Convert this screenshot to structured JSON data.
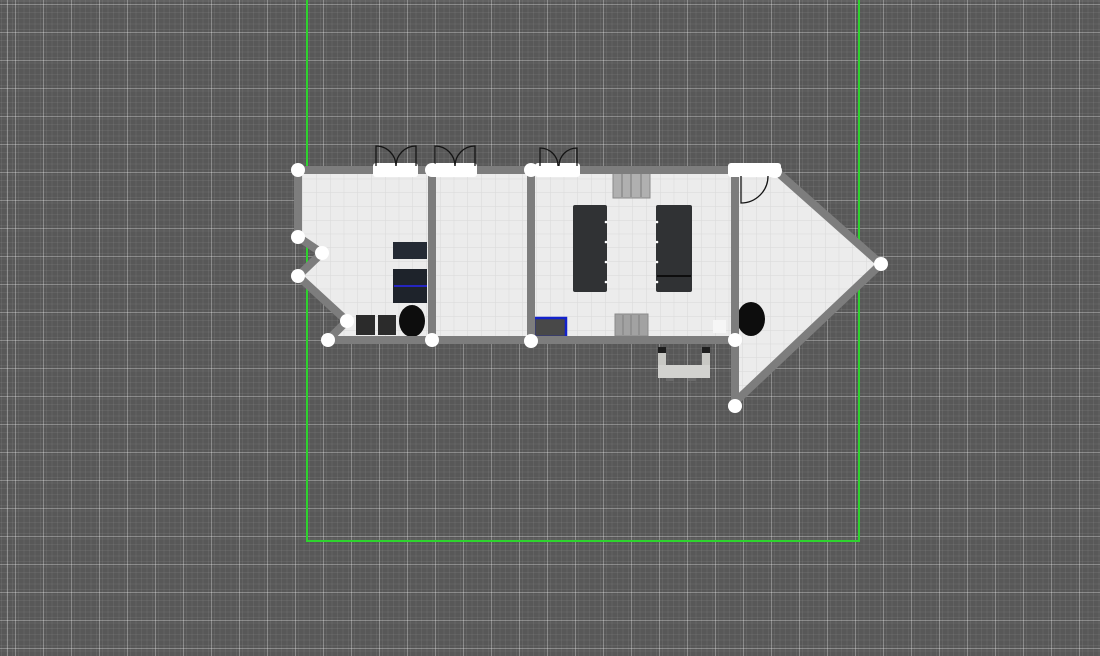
{
  "canvas": {
    "width": 1100,
    "height": 656,
    "background": "#585858"
  },
  "grid": {
    "major_spacing": 28,
    "minor_spacing": 5.6,
    "major_color": "rgba(255,255,255,0.30)",
    "minor_color": "rgba(255,255,255,0.06)"
  },
  "selection_bounds": {
    "name": "plan-boundary-rectangle",
    "color": "#2ed32e",
    "stroke_width": 2,
    "points": "307,0 307,541 859,541 859,0"
  },
  "floor": {
    "name": "building-floor",
    "fill": "#ececec",
    "grid_spacing": 13.75,
    "grid_color": "rgba(100,100,100,0.14)",
    "outline_points": "298,170 775,170 881,264 735,406 735,340 328,340 347,321 298,276 322,253 298,237"
  },
  "walls": {
    "color": "#7d7d7d",
    "thickness": 8,
    "polylines": [
      {
        "name": "wall-top-and-roof-gable",
        "points": "294,170 775,170 881,264 735,402"
      },
      {
        "name": "wall-left-zigzag",
        "points": "298,166 298,237 322,253 298,276 347,321 328,340"
      },
      {
        "name": "wall-bottom",
        "points": "324,340 737,340"
      },
      {
        "name": "wall-interior-1",
        "points": "432,170 432,340"
      },
      {
        "name": "wall-interior-2",
        "points": "531,170 531,340"
      },
      {
        "name": "wall-interior-3",
        "points": "735,166 735,406"
      }
    ]
  },
  "doors": {
    "gap_color": "#ffffff",
    "arc_color": "#141414",
    "wall_face_y": 166,
    "openings": [
      {
        "name": "double-door-1",
        "x": 373,
        "y": 163,
        "w": 45,
        "h": 14,
        "hinge1": 376,
        "hinge2": 416,
        "r": 20
      },
      {
        "name": "double-door-2",
        "x": 430,
        "y": 163,
        "w": 47,
        "h": 14,
        "hinge1": 435,
        "hinge2": 475,
        "r": 20
      },
      {
        "name": "double-door-3",
        "x": 535,
        "y": 163,
        "w": 45,
        "h": 14,
        "hinge1": 540,
        "hinge2": 577,
        "r": 18
      },
      {
        "name": "door-4",
        "x": 728,
        "y": 163,
        "w": 53,
        "h": 14
      }
    ],
    "swing_door": {
      "name": "door-4-swing",
      "hinge_x": 741,
      "hinge_y": 176,
      "radius": 27
    }
  },
  "handles": {
    "color": "#ffffff",
    "radius": 7,
    "points": [
      [
        298,
        170
      ],
      [
        298,
        237
      ],
      [
        322,
        253
      ],
      [
        298,
        276
      ],
      [
        347,
        321
      ],
      [
        328,
        340
      ],
      [
        432,
        170
      ],
      [
        432,
        340
      ],
      [
        531,
        170
      ],
      [
        531,
        341
      ],
      [
        735,
        170
      ],
      [
        775,
        171
      ],
      [
        881,
        264
      ],
      [
        735,
        340
      ],
      [
        735,
        406
      ]
    ]
  },
  "furniture": [
    {
      "type": "rect",
      "name": "cabinet-top",
      "x": 393,
      "y": 242,
      "w": 34,
      "h": 17,
      "fill": "#242a34"
    },
    {
      "type": "rect",
      "name": "cabinet-bottom",
      "x": 393,
      "y": 269,
      "w": 34,
      "h": 34,
      "fill": "#1e232b"
    },
    {
      "type": "line",
      "name": "selected-edge-highlight",
      "x1": 394,
      "y1": 286,
      "x2": 427,
      "y2": 286,
      "stroke": "#2525c0",
      "sw": 2
    },
    {
      "type": "rect",
      "name": "locker-1",
      "x": 356,
      "y": 315,
      "w": 19,
      "h": 20,
      "fill": "#2b2b2b"
    },
    {
      "type": "rect",
      "name": "locker-2",
      "x": 378,
      "y": 315,
      "w": 18,
      "h": 20,
      "fill": "#2b2b2b"
    },
    {
      "type": "ellipse",
      "name": "round-table-left",
      "cx": 412,
      "cy": 321,
      "rx": 13,
      "ry": 16,
      "fill": "#0d0d0d"
    },
    {
      "type": "rect",
      "name": "radiator-top",
      "x": 613,
      "y": 173,
      "w": 37,
      "h": 25,
      "fill": "#b0b0b0",
      "stroke": "#8a8a8a",
      "lines_x": [
        622,
        631,
        641
      ]
    },
    {
      "type": "rect",
      "name": "conference-table-left",
      "x": 573,
      "y": 205,
      "w": 34,
      "h": 87,
      "fill": "#303234",
      "rx": 2
    },
    {
      "type": "rect",
      "name": "conference-table-right",
      "x": 656,
      "y": 205,
      "w": 36,
      "h": 87,
      "fill": "#303234",
      "rx": 2
    },
    {
      "type": "line",
      "name": "table-right-divider",
      "x1": 657,
      "y1": 276,
      "x2": 691,
      "y2": 276,
      "stroke": "#0d0d0d",
      "sw": 2
    },
    {
      "type": "rect",
      "name": "radiator-bottom",
      "x": 615,
      "y": 314,
      "w": 33,
      "h": 22,
      "fill": "#a2a2a2",
      "stroke": "#8a8a8a",
      "lines_x": [
        623,
        631,
        639
      ]
    },
    {
      "type": "rect",
      "name": "selected-furniture-box",
      "x": 534,
      "y": 318,
      "w": 32,
      "h": 19,
      "fill": "#484848",
      "stroke": "#1322cc",
      "sw": 2.5
    },
    {
      "type": "rect",
      "name": "white-box",
      "x": 713,
      "y": 320,
      "w": 13,
      "h": 13,
      "fill": "#f6f6f6"
    },
    {
      "type": "ellipse",
      "name": "round-table-right",
      "cx": 751,
      "cy": 319,
      "rx": 14,
      "ry": 17,
      "fill": "#0d0d0d"
    },
    {
      "type": "rect",
      "name": "bench-left-arm",
      "x": 658,
      "y": 347,
      "w": 8,
      "h": 26,
      "fill": "#c8c8c4"
    },
    {
      "type": "rect",
      "name": "bench-right-arm",
      "x": 702,
      "y": 347,
      "w": 8,
      "h": 26,
      "fill": "#c8c8c4"
    },
    {
      "type": "rect",
      "name": "bench-left-arm-tip",
      "x": 658,
      "y": 347,
      "w": 8,
      "h": 6,
      "fill": "#1e1e1e"
    },
    {
      "type": "rect",
      "name": "bench-right-arm-tip",
      "x": 702,
      "y": 347,
      "w": 8,
      "h": 6,
      "fill": "#1e1e1e"
    },
    {
      "type": "rect",
      "name": "bench-seat",
      "x": 658,
      "y": 365,
      "w": 52,
      "h": 13,
      "fill": "#d2d2cf"
    },
    {
      "type": "rect",
      "name": "bench-foot-1",
      "x": 666,
      "y": 378,
      "w": 8,
      "h": 3,
      "fill": "#6a6a6a"
    },
    {
      "type": "rect",
      "name": "bench-foot-2",
      "x": 688,
      "y": 378,
      "w": 8,
      "h": 3,
      "fill": "#6a6a6a"
    }
  ],
  "chair_dots": {
    "color": "#ffffff",
    "radius": 1.3,
    "points": [
      [
        606,
        222
      ],
      [
        606,
        242
      ],
      [
        606,
        262
      ],
      [
        606,
        282
      ],
      [
        657,
        222
      ],
      [
        657,
        242
      ],
      [
        657,
        262
      ],
      [
        657,
        282
      ]
    ]
  }
}
